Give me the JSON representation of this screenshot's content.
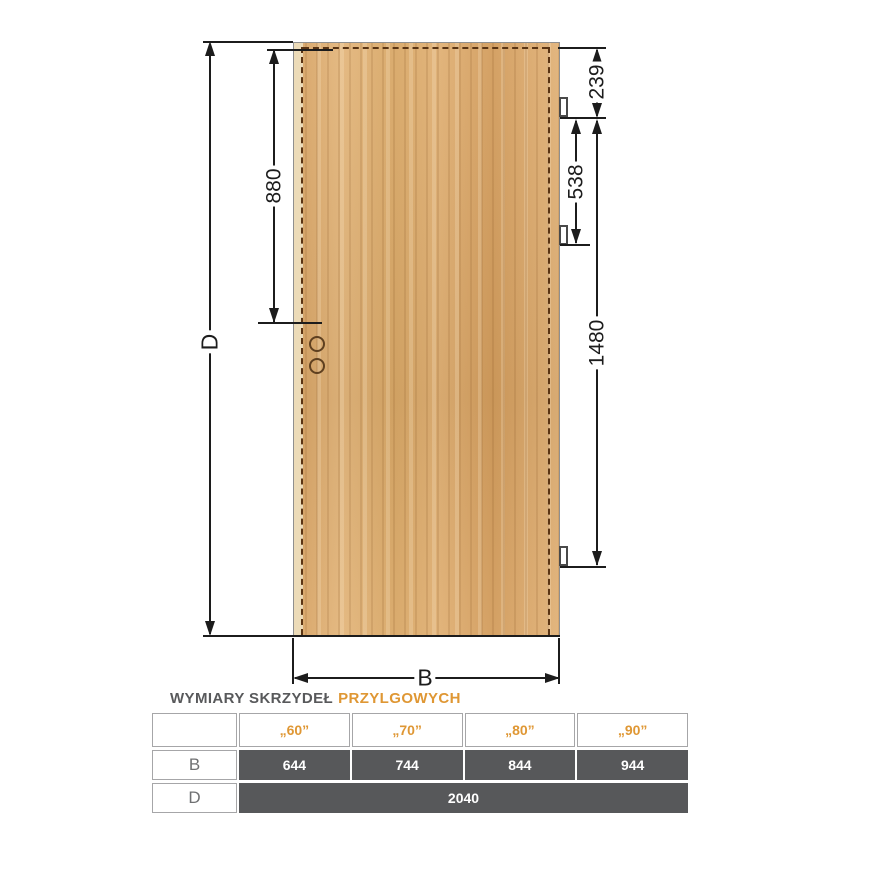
{
  "diagram": {
    "labels": {
      "d": "D",
      "b": "B",
      "v880": "880",
      "v239": "239",
      "v538": "538",
      "v1480": "1480"
    }
  },
  "table": {
    "title": {
      "part1": "WYMIARY SKRZYDEŁ",
      "part2": "PRZYLGOWYCH"
    },
    "columns": [
      "„60”",
      "„70”",
      "„80”",
      "„90”"
    ],
    "row_b": {
      "label": "B",
      "values": [
        "644",
        "744",
        "844",
        "944"
      ]
    },
    "row_d": {
      "label": "D",
      "value": "2040"
    }
  },
  "colors": {
    "accent_orange": "#df9734",
    "table_dark_gray": "#57585a",
    "wood": "#dcab6e",
    "dash_brown": "#5a3413"
  }
}
